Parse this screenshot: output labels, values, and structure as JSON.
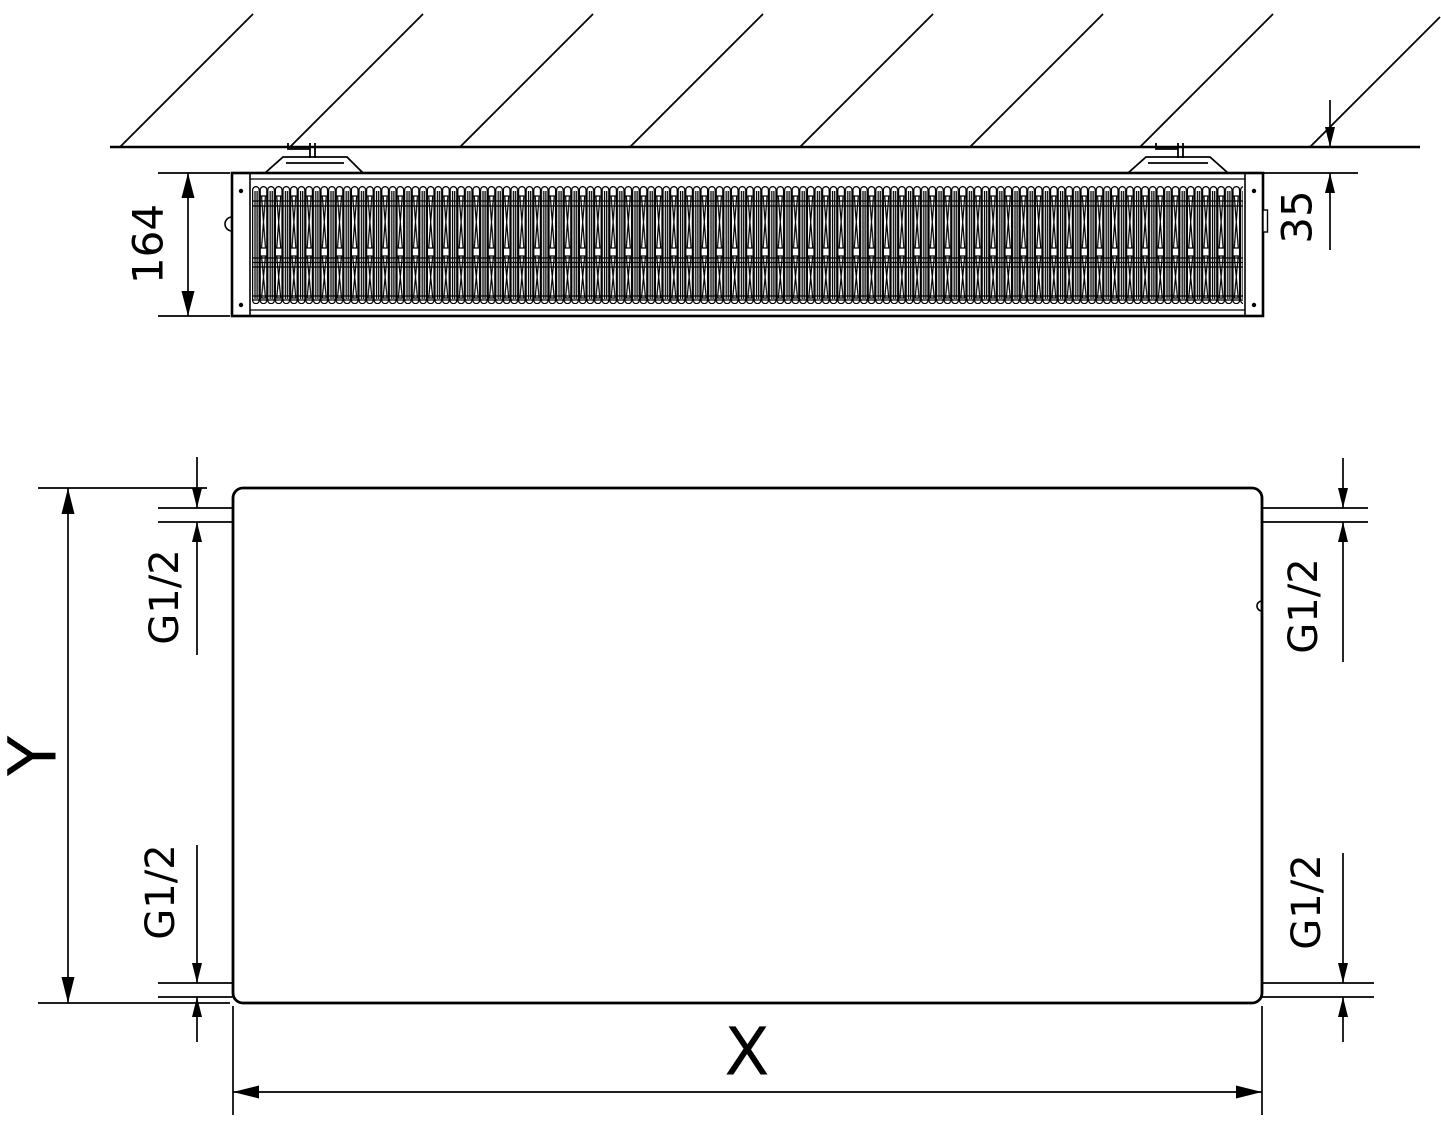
{
  "diagram": {
    "type": "radiator-technical-drawing",
    "colors": {
      "line": "#000000",
      "background": "#ffffff"
    },
    "side_view": {
      "depth_label": "164",
      "wall_gap_label": "35"
    },
    "front_view": {
      "width_label": "X",
      "height_label": "Y",
      "connections": {
        "top_left": "G1/2",
        "top_right": "G1/2",
        "bottom_left": "G1/2",
        "bottom_right": "G1/2"
      }
    }
  }
}
